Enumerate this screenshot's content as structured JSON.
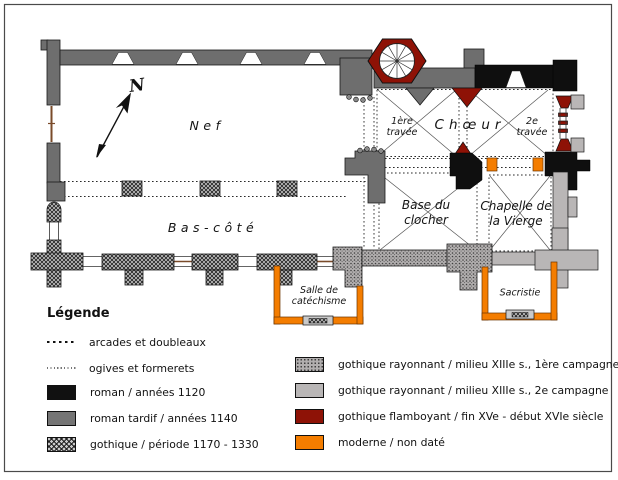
{
  "plan": {
    "north_indicator": "N",
    "rooms": {
      "nef": "Nef",
      "bas_cote": "Bas-côté",
      "choeur": "Chœur",
      "travee1": {
        "line1": "1ère",
        "line2": "travée"
      },
      "travee2": {
        "line1": "2e",
        "line2": "travée"
      },
      "clocher": {
        "line1": "Base du",
        "line2": "clocher"
      },
      "chapelle": {
        "line1": "Chapelle de",
        "line2": "la Vierge"
      },
      "salle": {
        "line1": "Salle de",
        "line2": "catéchisme"
      },
      "sacristie": "Sacristie"
    }
  },
  "legend": {
    "title": "Légende",
    "left": [
      {
        "type": "dash-coarse",
        "label": "arcades et doubleaux"
      },
      {
        "type": "dash-fine",
        "label": "ogives et formerets"
      },
      {
        "type": "solid",
        "color": "#111111",
        "label": "roman / années 1120"
      },
      {
        "type": "solid",
        "color": "#757575",
        "label": "roman tardif / années 1140"
      },
      {
        "type": "crosshatch",
        "label": "gothique / période 1170 - 1330"
      }
    ],
    "right": [
      {
        "type": "speckle",
        "color": "#b1aeae",
        "label": "gothique rayonnant / milieu XIIIe s., 1ère campagne"
      },
      {
        "type": "solid",
        "color": "#b9b6b6",
        "label": "gothique rayonnant / milieu XIIIe s., 2e campagne"
      },
      {
        "type": "solid",
        "color": "#8e1206",
        "label": "gothique flamboyant / fin XVe - début XVIe siècle"
      },
      {
        "type": "solid",
        "color": "#f47d00",
        "label": "moderne / non daté"
      }
    ]
  },
  "colors": {
    "roman": "#111111",
    "roman_tardif": "#6e6e6e",
    "gothique_hatch_bg": "#c9c9c9",
    "rayonnant_1": "#b1aeae",
    "rayonnant_2": "#b9b6b6",
    "flamboyant": "#8e1206",
    "moderne": "#f47d00"
  }
}
